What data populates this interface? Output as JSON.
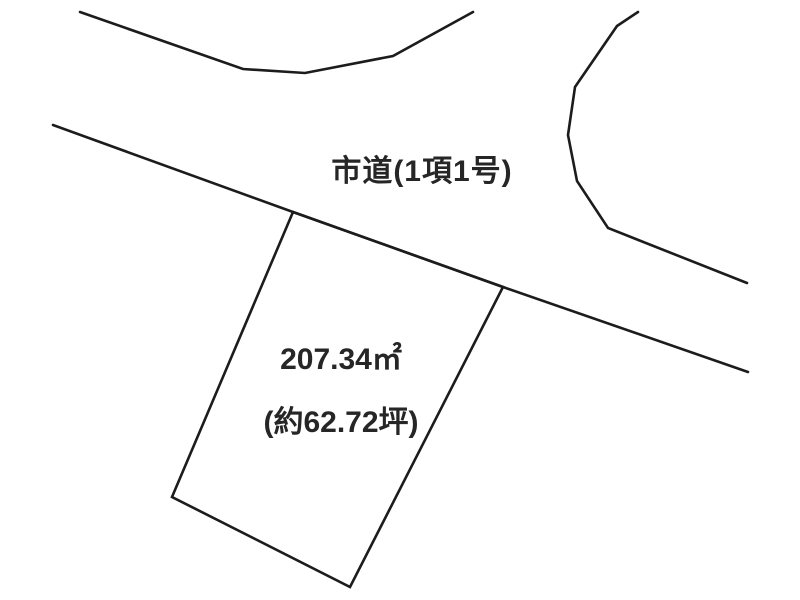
{
  "plan": {
    "road_label": "市道(1項1号)",
    "parcel": {
      "area_sqm": "207.34㎡",
      "area_tsubo": "(約62.72坪)"
    },
    "colors": {
      "background": "#ffffff",
      "line": "#1c1c1c",
      "text": "#262626"
    },
    "shapes": {
      "stroke_width": 2.6,
      "polylines": [
        {
          "name": "road-upper-left-boundary",
          "points": [
            [
              80,
              12
            ],
            [
              243,
              69
            ],
            [
              305,
              73
            ],
            [
              393,
              56
            ],
            [
              473,
              12
            ]
          ]
        },
        {
          "name": "road-upper-right-boundary",
          "points": [
            [
              638,
              12
            ],
            [
              617,
              26
            ],
            [
              575,
              87
            ],
            [
              568,
              135
            ],
            [
              577,
              181
            ],
            [
              608,
              228
            ],
            [
              747,
              283
            ]
          ]
        },
        {
          "name": "road-lower-boundary",
          "points": [
            [
              53,
              125
            ],
            [
              293,
              212
            ],
            [
              503,
              287
            ],
            [
              748,
              372
            ]
          ]
        }
      ],
      "polygons": [
        {
          "name": "parcel-outline",
          "points": [
            [
              293,
              212
            ],
            [
              503,
              287
            ],
            [
              350,
              587
            ],
            [
              172,
              497
            ]
          ]
        }
      ]
    }
  }
}
